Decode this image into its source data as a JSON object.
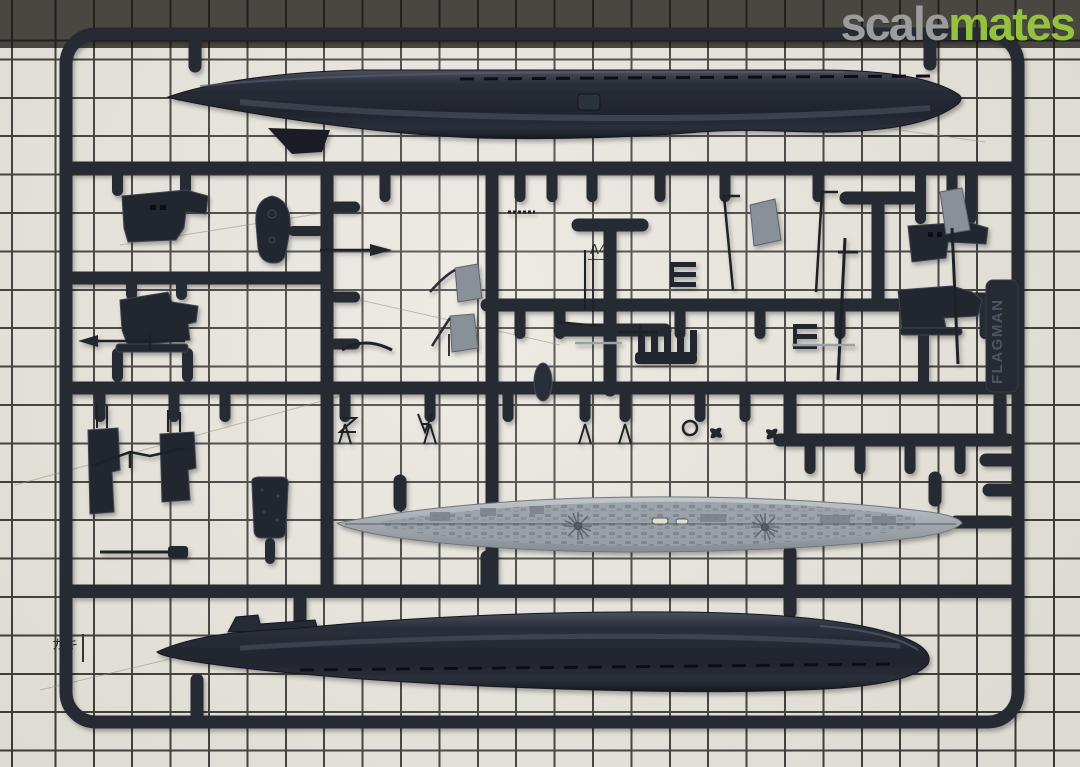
{
  "watermark": {
    "text_scale": "scale",
    "text_mates": "mates",
    "color_scale": "#9c9c9c",
    "color_mates": "#94c13e"
  },
  "sprue": {
    "brand_tab_text": "FLAGMAN",
    "plastic_color": "#262a33",
    "deck_color": "#9aa1a8",
    "parts": [
      "upper-hull-half",
      "main-deck",
      "lower-hull-half",
      "conning-tower-halves",
      "periscopes-and-masts",
      "propellers-and-fittings",
      "brand-tab"
    ]
  },
  "mat": {
    "base_color": "#e9e6dd",
    "top_band_color": "#4a4742",
    "grid_color": "#3c3b38",
    "size_labels": [
      {
        "text": "A4"
      },
      {
        "text": "B5"
      },
      {
        "text": "ガキ"
      }
    ]
  }
}
